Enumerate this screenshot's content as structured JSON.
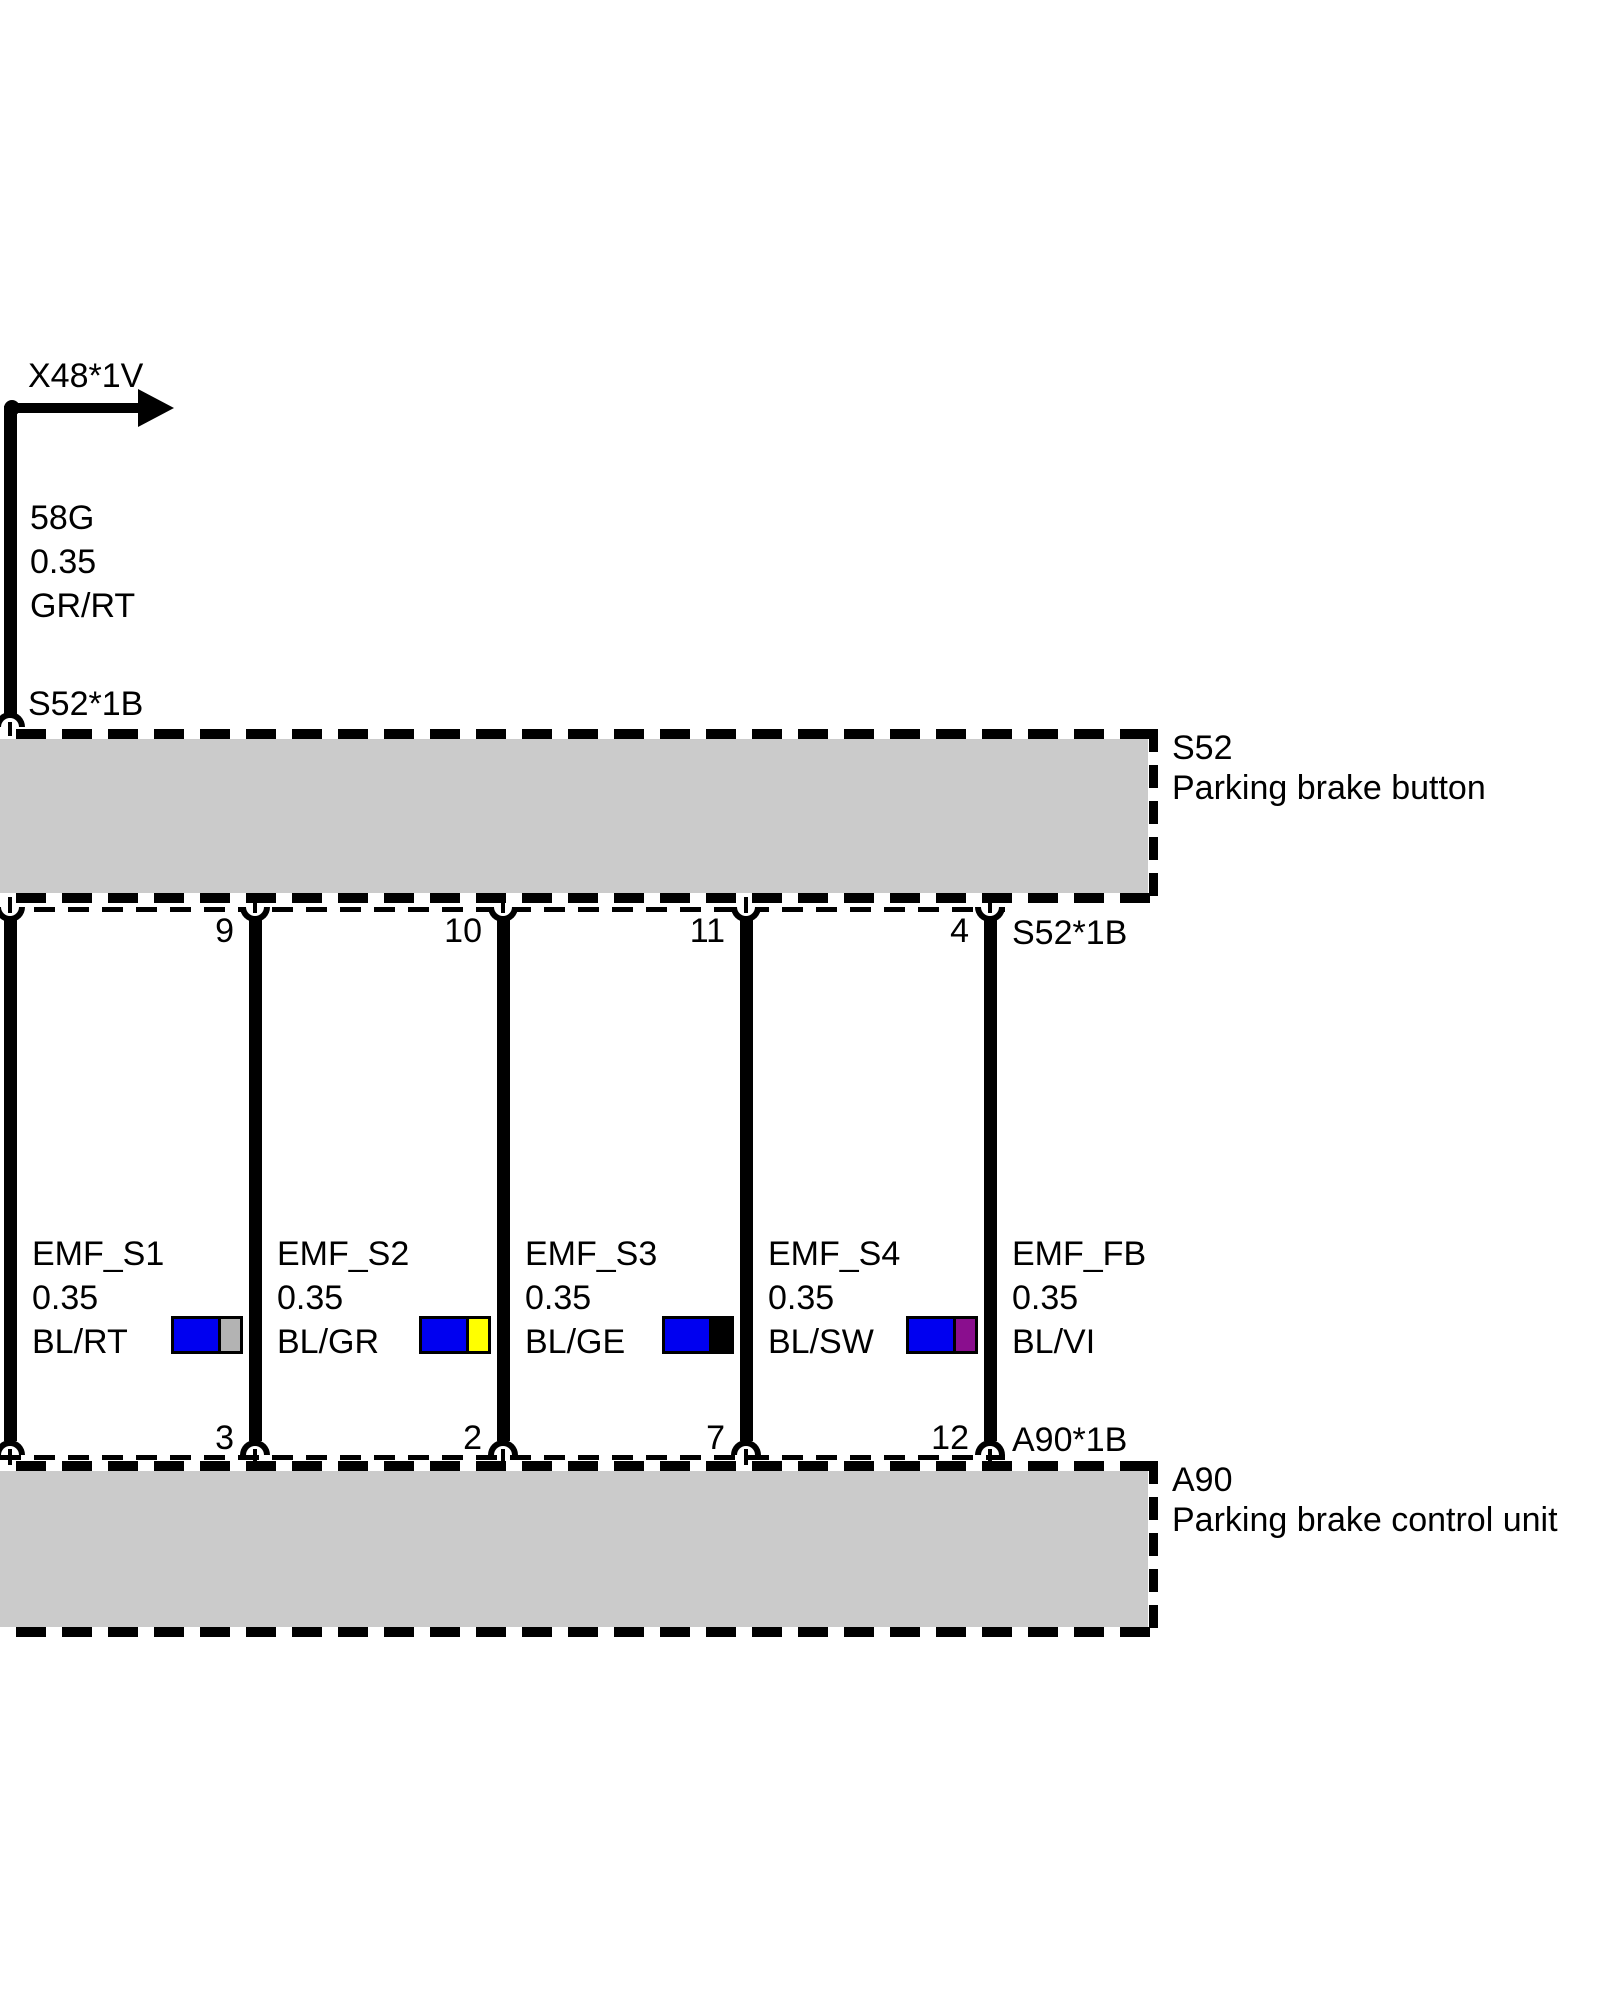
{
  "branch": {
    "connector_label": "X48*1V",
    "wire": {
      "circuit": "58G",
      "cross_section": "0.35",
      "color_code": "GR/RT"
    },
    "connector_bottom": "S52*1B"
  },
  "s52": {
    "code": "S52",
    "name": "Parking brake button",
    "connector": "S52*1B"
  },
  "a90": {
    "code": "A90",
    "name": "Parking brake control unit",
    "connector": "A90*1B"
  },
  "wires": [
    {
      "signal": "EMF_S1",
      "cross_section": "0.35",
      "color_code": "BL/RT",
      "s52_pin": "",
      "a90_pin": ""
    },
    {
      "signal": "EMF_S2",
      "cross_section": "0.35",
      "color_code": "BL/GR",
      "s52_pin": "9",
      "a90_pin": "3",
      "swatch_main": "#0000f0",
      "swatch_second": "#b3b3b3"
    },
    {
      "signal": "EMF_S3",
      "cross_section": "0.35",
      "color_code": "BL/GE",
      "s52_pin": "10",
      "a90_pin": "2",
      "swatch_main": "#0000f0",
      "swatch_second": "#ffff00"
    },
    {
      "signal": "EMF_S4",
      "cross_section": "0.35",
      "color_code": "BL/SW",
      "s52_pin": "11",
      "a90_pin": "7",
      "swatch_main": "#0000f0",
      "swatch_second": "#000000"
    },
    {
      "signal": "EMF_FB",
      "cross_section": "0.35",
      "color_code": "BL/VI",
      "s52_pin": "4",
      "a90_pin": "12",
      "swatch_main": "#0000f0",
      "swatch_second": "#8a0e8e"
    }
  ],
  "colors": {
    "box_fill": "#cbcbcb",
    "wire_blue": "#0000f0"
  }
}
